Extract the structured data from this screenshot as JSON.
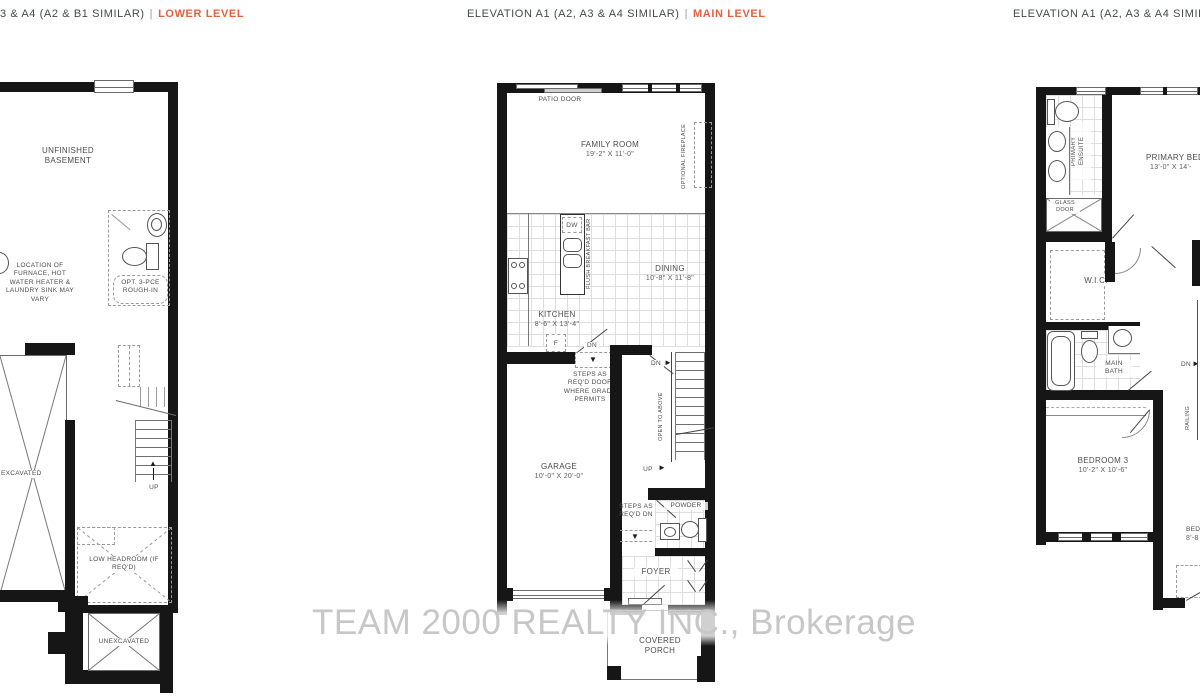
{
  "headers": {
    "left": {
      "prefix": "3 & A4 (A2 & B1 SIMILAR)",
      "separator": "|",
      "level": "LOWER LEVEL"
    },
    "middle": {
      "prefix": "ELEVATION A1 (A2, A3 & A4 SIMILAR)",
      "separator": "|",
      "level": "MAIN LEVEL"
    },
    "right": {
      "prefix": "ELEVATION A1 (A2, A3 & A4 SIMILAR",
      "separator": "",
      "level": ""
    }
  },
  "colors": {
    "accent": "#e4603f",
    "header_text": "#44494e",
    "wall": "#161616",
    "watermark": "#c7c7c7"
  },
  "watermark": "TEAM 2000 REALTY INC., Brokerage",
  "icons": {
    "up_arrow": "▲",
    "down_arrow": "▼",
    "right_arrow": "►"
  },
  "plans": {
    "lower": {
      "labels": {
        "unfinished_basement": "UNFINISHED BASEMENT",
        "furnace_note": "LOCATION OF FURNACE, HOT WATER HEATER & LAUNDRY SINK MAY VARY",
        "rough_in": "OPT. 3-PCE ROUGH-IN",
        "excavated": "EXCAVATED",
        "up": "UP",
        "low_headroom": "LOW HEADROOM (IF REQ'D)",
        "unexcavated": "UNEXCAVATED"
      }
    },
    "main": {
      "labels": {
        "patio_door": "PATIO DOOR",
        "family_room": "FAMILY ROOM",
        "family_room_dims": "19'-2\" X 11'-0\"",
        "optional_fireplace": "OPTIONAL FIREPLACE",
        "dw": "DW",
        "flush_breakfast_bar": "FLUSH BREAKFAST BAR",
        "dining": "DINING",
        "dining_dims": "10'-8\" X 11'-8\"",
        "kitchen": "KITCHEN",
        "kitchen_dims": "8'-6\" X 13'-4\"",
        "fridge": "F",
        "dn_kitchen": "DN",
        "steps_grade_note": "STEPS AS REQ'D DOOR WHERE GRADE PERMITS",
        "dn_stairs": "DN",
        "open_to_above": "OPEN TO ABOVE",
        "up_stairs": "UP",
        "garage": "GARAGE",
        "garage_dims": "10'-0\" X 20'-0\"",
        "steps_reqd_dn": "STEPS AS REQ'D DN",
        "powder": "POWDER",
        "foyer": "FOYER",
        "covered_porch": "COVERED PORCH"
      }
    },
    "upper": {
      "labels": {
        "primary_ensuite": "PRIMARY ENSUITE",
        "glass_door": "GLASS DOOR",
        "primary_bedroom": "PRIMARY BEDRO",
        "primary_bedroom_dims": "13'-0\" X 14'-",
        "wic": "W.I.C.",
        "main_bath": "MAIN BATH",
        "dn": "DN",
        "railing": "RAILING",
        "bedroom3": "BEDROOM 3",
        "bedroom3_dims": "10'-2\" X 10'-6\"",
        "bedroom2": "BED",
        "bedroom2_dims": "8'-8"
      }
    }
  }
}
